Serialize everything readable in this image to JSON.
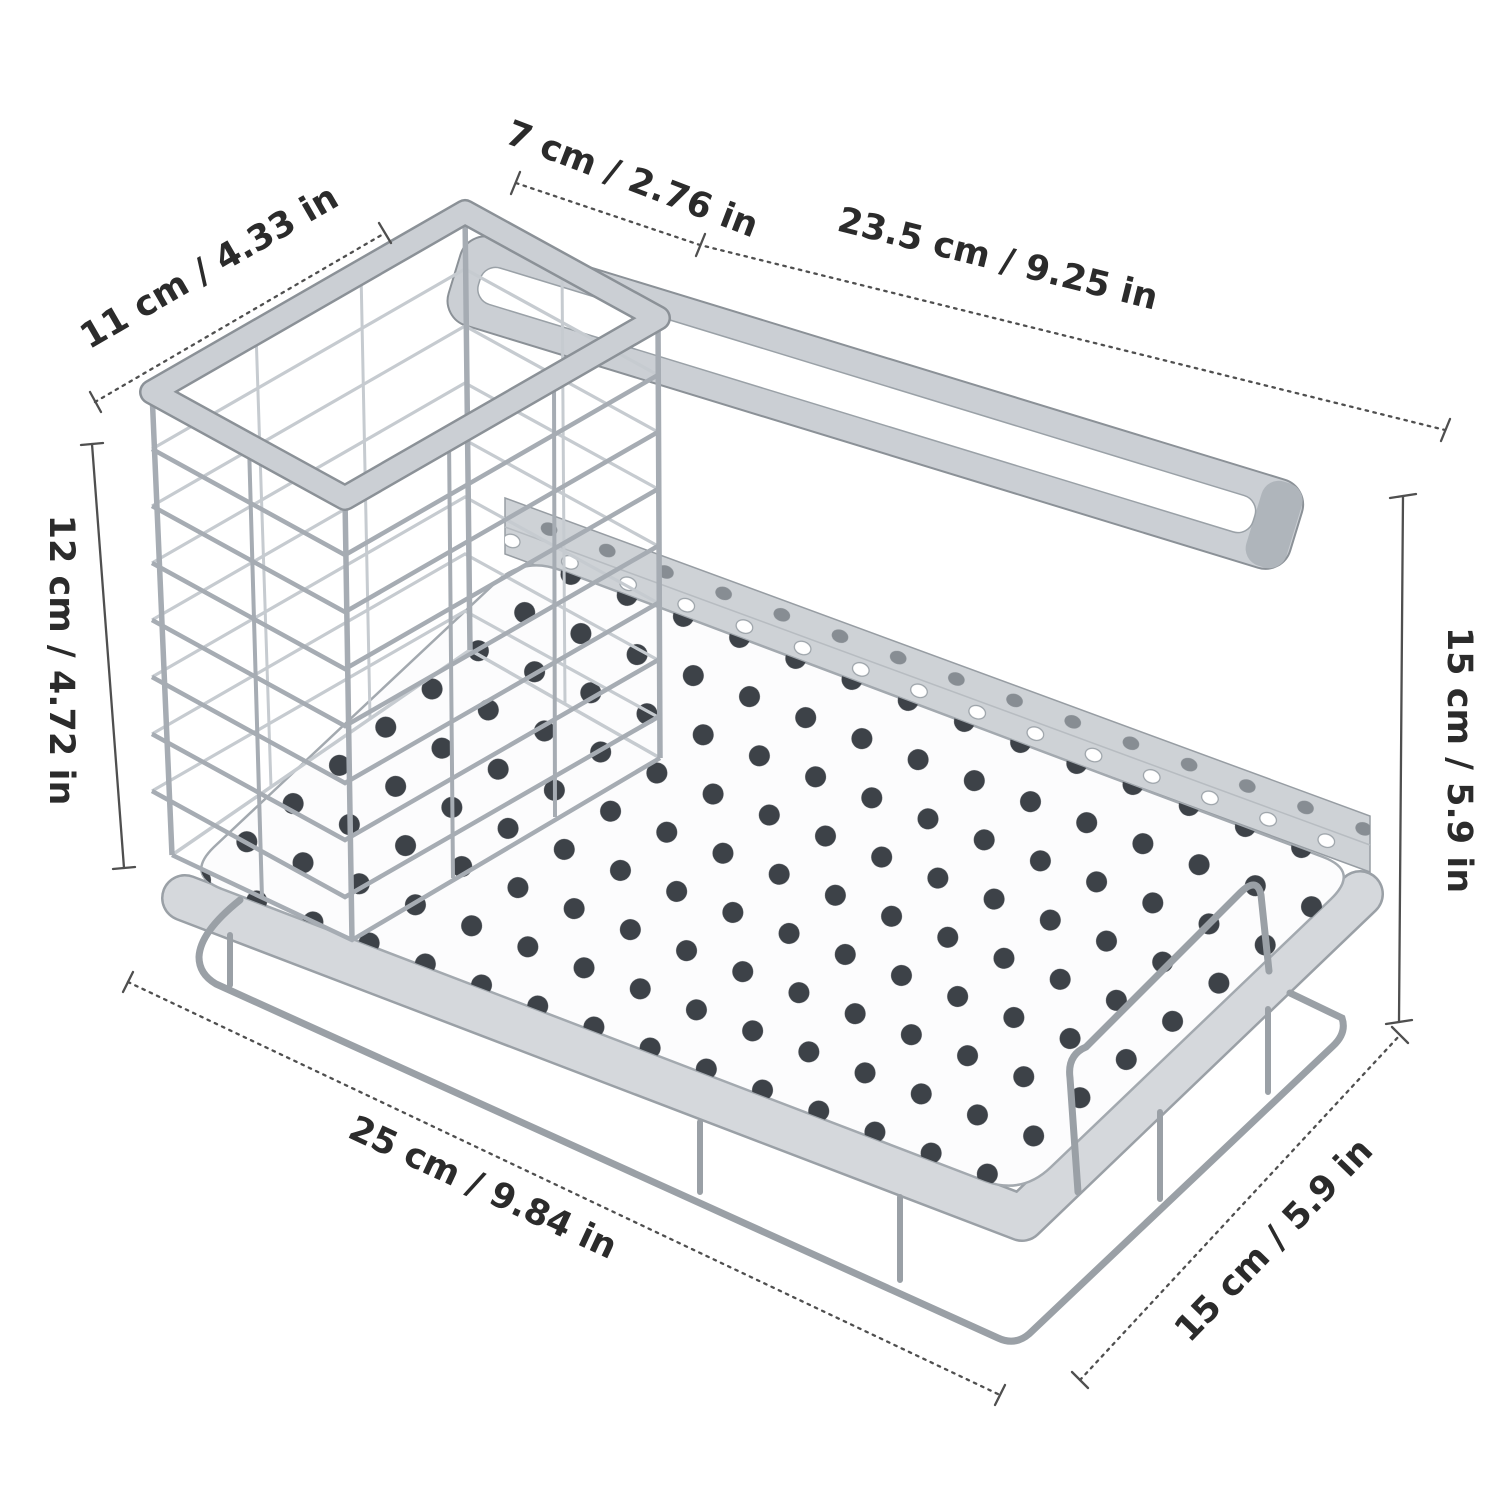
{
  "figure": {
    "background": "#ffffff",
    "dimension_line_color": "#4f4f4f",
    "label_text_color": "#2b2b2b",
    "metal_fill_color": "#cbcfd4",
    "metal_edge_color": "#8b9197",
    "wire_color": "#a6acb3",
    "drain_hole_color": "#3d4248"
  },
  "dimensions": {
    "basket_depth": {
      "label": "11 cm / 4.33 in"
    },
    "basket_height": {
      "label": "12 cm / 4.72 in"
    },
    "basket_width": {
      "label": "7 cm / 2.76 in"
    },
    "bar_length": {
      "label": "23.5 cm / 9.25 in"
    },
    "overall_height": {
      "label": "15 cm / 5.9 in"
    },
    "base_length": {
      "label": "25 cm / 9.84 in"
    },
    "base_depth": {
      "label": "15 cm / 5.9 in"
    }
  }
}
